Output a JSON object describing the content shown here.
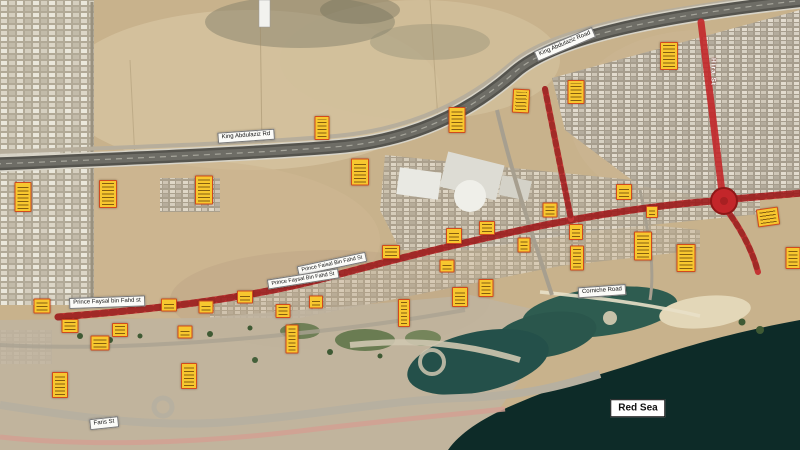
{
  "map": {
    "description": "Annotated satellite map of a coastal road corridor with survey markers",
    "sea_label": "Red Sea",
    "colors": {
      "marker_fill": "#f7c72f",
      "marker_border": "#d14a1d",
      "red_corridor": "#c3262a",
      "sea": "#0d2b28",
      "lagoon": "#2e5c50",
      "sand": "#c8b28c"
    },
    "roads": {
      "highway_name": "King Abdulaziz Road",
      "corridor_name": "Prince Faisal Bin Fahd St",
      "coastal_name": "Corniche Road",
      "cross_name": "Hira St",
      "local_name": "Faris St"
    },
    "labels": [
      {
        "name": "king-abdulaziz-rd-label-west",
        "text": "King Abdulaziz Rd",
        "x": 246,
        "y": 136,
        "rot": -4,
        "fs": 6,
        "style": "box"
      },
      {
        "name": "king-abdulaziz-rd-label-east",
        "text": "King Abdulaziz Road",
        "x": 565,
        "y": 44,
        "rot": -23,
        "fs": 6,
        "style": "box"
      },
      {
        "name": "prince-faisal-label-upper",
        "text": "Prince Faisal Bin Fahd St",
        "x": 332,
        "y": 264,
        "rot": -12,
        "fs": 5.5,
        "style": "box"
      },
      {
        "name": "prince-faisal-label-lower",
        "text": "Prince Faysal Bin Fahd St",
        "x": 303,
        "y": 279,
        "rot": -9,
        "fs": 5.5,
        "style": "box"
      },
      {
        "name": "prince-faisal-label-west",
        "text": "Prince Faysal bin Fahd st",
        "x": 107,
        "y": 302,
        "rot": -2,
        "fs": 6,
        "style": "box"
      },
      {
        "name": "corniche-road-label",
        "text": "Corniche Road",
        "x": 602,
        "y": 291,
        "rot": -4,
        "fs": 6,
        "style": "box"
      },
      {
        "name": "faris-st-label",
        "text": "Faris St",
        "x": 104,
        "y": 423,
        "rot": -6,
        "fs": 6,
        "style": "box"
      },
      {
        "name": "hira-st-label",
        "text": "Hira St",
        "x": 713,
        "y": 72,
        "rot": 90,
        "fs": 6.5,
        "style": "onroad"
      },
      {
        "name": "red-sea-label",
        "text": "Red Sea",
        "x": 638,
        "y": 408,
        "rot": 0,
        "fs": 10,
        "style": "sea"
      }
    ],
    "markers": [
      {
        "x": 322,
        "y": 128,
        "w": 13,
        "h": 22,
        "rot": 0
      },
      {
        "x": 457,
        "y": 120,
        "w": 15,
        "h": 24,
        "rot": 0
      },
      {
        "x": 521,
        "y": 101,
        "w": 15,
        "h": 22,
        "rot": 3
      },
      {
        "x": 576,
        "y": 92,
        "w": 15,
        "h": 22,
        "rot": 0
      },
      {
        "x": 669,
        "y": 56,
        "w": 16,
        "h": 26,
        "rot": 0
      },
      {
        "x": 23,
        "y": 197,
        "w": 15,
        "h": 28,
        "rot": 0
      },
      {
        "x": 108,
        "y": 194,
        "w": 16,
        "h": 26,
        "rot": 0
      },
      {
        "x": 204,
        "y": 190,
        "w": 16,
        "h": 27,
        "rot": 0
      },
      {
        "x": 360,
        "y": 172,
        "w": 16,
        "h": 25,
        "rot": 0
      },
      {
        "x": 624,
        "y": 192,
        "w": 14,
        "h": 14,
        "rot": 0
      },
      {
        "x": 550,
        "y": 210,
        "w": 13,
        "h": 13,
        "rot": 0
      },
      {
        "x": 652,
        "y": 212,
        "w": 10,
        "h": 10,
        "rot": 0
      },
      {
        "x": 487,
        "y": 228,
        "w": 14,
        "h": 12,
        "rot": 0
      },
      {
        "x": 454,
        "y": 236,
        "w": 14,
        "h": 14,
        "rot": 0
      },
      {
        "x": 576,
        "y": 232,
        "w": 12,
        "h": 14,
        "rot": 0
      },
      {
        "x": 524,
        "y": 245,
        "w": 11,
        "h": 13,
        "rot": 0
      },
      {
        "x": 643,
        "y": 246,
        "w": 16,
        "h": 27,
        "rot": 0
      },
      {
        "x": 686,
        "y": 258,
        "w": 17,
        "h": 26,
        "rot": 0
      },
      {
        "x": 577,
        "y": 258,
        "w": 12,
        "h": 23,
        "rot": 0
      },
      {
        "x": 768,
        "y": 217,
        "w": 20,
        "h": 16,
        "rot": -8
      },
      {
        "x": 793,
        "y": 258,
        "w": 13,
        "h": 20,
        "rot": 0
      },
      {
        "x": 391,
        "y": 252,
        "w": 16,
        "h": 12,
        "rot": 0
      },
      {
        "x": 42,
        "y": 306,
        "w": 15,
        "h": 13,
        "rot": 0
      },
      {
        "x": 70,
        "y": 326,
        "w": 15,
        "h": 12,
        "rot": 0
      },
      {
        "x": 100,
        "y": 343,
        "w": 17,
        "h": 13,
        "rot": 0
      },
      {
        "x": 120,
        "y": 330,
        "w": 14,
        "h": 12,
        "rot": 0
      },
      {
        "x": 60,
        "y": 385,
        "w": 14,
        "h": 24,
        "rot": 0
      },
      {
        "x": 169,
        "y": 305,
        "w": 14,
        "h": 11,
        "rot": 0
      },
      {
        "x": 206,
        "y": 307,
        "w": 13,
        "h": 11,
        "rot": 0
      },
      {
        "x": 185,
        "y": 332,
        "w": 13,
        "h": 11,
        "rot": 0
      },
      {
        "x": 245,
        "y": 297,
        "w": 14,
        "h": 11,
        "rot": 0
      },
      {
        "x": 283,
        "y": 311,
        "w": 13,
        "h": 12,
        "rot": 0
      },
      {
        "x": 189,
        "y": 376,
        "w": 14,
        "h": 24,
        "rot": 0
      },
      {
        "x": 292,
        "y": 339,
        "w": 11,
        "h": 27,
        "rot": 0
      },
      {
        "x": 316,
        "y": 302,
        "w": 12,
        "h": 11,
        "rot": 0
      },
      {
        "x": 404,
        "y": 313,
        "w": 10,
        "h": 26,
        "rot": 0
      },
      {
        "x": 460,
        "y": 297,
        "w": 14,
        "h": 18,
        "rot": 0
      },
      {
        "x": 486,
        "y": 288,
        "w": 13,
        "h": 16,
        "rot": 0
      },
      {
        "x": 447,
        "y": 266,
        "w": 13,
        "h": 11,
        "rot": 0
      }
    ]
  }
}
